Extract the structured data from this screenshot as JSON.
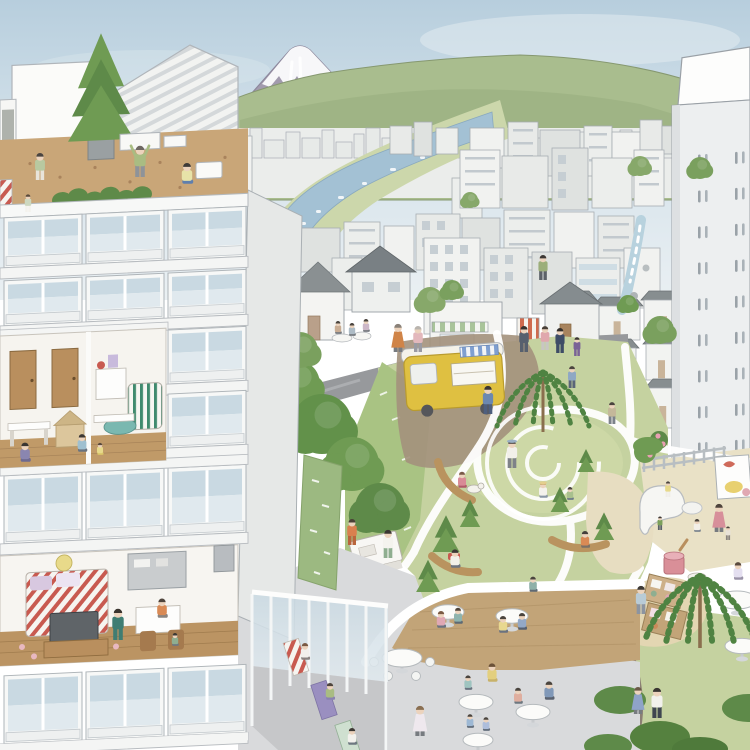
{
  "scene": {
    "description": "Watercolor illustration of a Japanese city: apartment tower cross-section with rooftop garden on the left, Mount Fuji and hills behind a dense low-rise city with a river, a waterfall stream, a park with winding white paths, spiral lawn, playground, yellow food-truck, market stalls, cafe plaza and a glass yoga studio."
  },
  "palette": {
    "sky_top": "#b7cedd",
    "sky": "#d3e1ea",
    "sky_low": "#e9eff3",
    "fuji": "#a29bae",
    "fuji_snow": "#f7f7f9",
    "hill": "#a9bd8e",
    "hill_dark": "#97ad7d",
    "field": "#ccd7ab",
    "river": "#a3c1d4",
    "city_base": "#ebedeb",
    "roof_dark": "#878e90",
    "road": "#97999c",
    "dirt": "#a3917c",
    "lawn": "#c5d2a0",
    "lawn_light": "#cdd8a6",
    "lawn_bright": "#a9c383",
    "path_white": "#ffffff",
    "soil": "#c9a678",
    "deck": "#c2a478",
    "plaza": "#d9dadc",
    "sand": "#e7ddc1",
    "truck_yellow": "#dfc041",
    "truck_trim": "#b99b2e",
    "awning_blue": "#7f9fd0",
    "moss": "#9cb981",
    "tree": "#6f9b53",
    "tree_dark": "#5e8a49",
    "willow": "#4f8342",
    "glass_top": "#c9d9e2",
    "glass_bottom": "#e0e9ee",
    "wood": "#b98f5e",
    "wall": "#f6f6f4",
    "wall_side": "#e6e8e7",
    "skin": "#ecd3bd",
    "stream": "#b8d2de",
    "bench_wood": "#b9935f",
    "cup_pink": "#d98f98",
    "flower_pink": "#e8a0b2"
  },
  "skyline": [
    [
      232,
      16,
      22
    ],
    [
      250,
      12,
      30
    ],
    [
      264,
      20,
      18
    ],
    [
      286,
      14,
      26
    ],
    [
      302,
      18,
      20
    ],
    [
      322,
      12,
      28
    ],
    [
      336,
      16,
      16
    ],
    [
      354,
      10,
      24
    ],
    [
      366,
      14,
      30
    ],
    [
      382,
      12,
      20
    ],
    [
      396,
      16,
      26
    ],
    [
      414,
      10,
      18
    ],
    [
      426,
      14,
      24
    ],
    [
      442,
      12,
      30
    ],
    [
      456,
      16,
      20
    ],
    [
      474,
      10,
      26
    ],
    [
      486,
      14,
      18
    ],
    [
      502,
      12,
      24
    ],
    [
      516,
      16,
      28
    ],
    [
      534,
      10,
      20
    ],
    [
      546,
      14,
      24
    ],
    [
      562,
      12,
      18
    ],
    [
      576,
      14,
      26
    ],
    [
      592,
      10,
      20
    ],
    [
      604,
      14,
      24
    ],
    [
      620,
      12,
      28
    ],
    [
      634,
      14,
      18
    ],
    [
      650,
      10,
      22
    ],
    [
      662,
      14,
      26
    ]
  ],
  "city": [
    [
      202,
      136,
      50,
      66,
      "d"
    ],
    [
      390,
      126,
      22,
      28,
      "p"
    ],
    [
      414,
      122,
      18,
      34,
      "p"
    ],
    [
      436,
      128,
      22,
      26,
      "p"
    ],
    [
      470,
      128,
      34,
      40,
      "p"
    ],
    [
      508,
      122,
      30,
      52,
      "d"
    ],
    [
      540,
      130,
      40,
      46,
      "p"
    ],
    [
      584,
      126,
      28,
      50,
      "d"
    ],
    [
      612,
      132,
      34,
      44,
      "p"
    ],
    [
      640,
      120,
      22,
      30,
      "p"
    ],
    [
      662,
      126,
      16,
      28,
      "p"
    ],
    [
      452,
      178,
      30,
      40,
      "p"
    ],
    [
      460,
      150,
      40,
      58,
      "d"
    ],
    [
      502,
      156,
      46,
      52,
      "p"
    ],
    [
      552,
      148,
      36,
      62,
      "g"
    ],
    [
      592,
      158,
      40,
      50,
      "p"
    ],
    [
      634,
      150,
      30,
      56,
      "d"
    ],
    [
      270,
      240,
      26,
      36,
      "p"
    ],
    [
      300,
      228,
      40,
      44,
      "p"
    ],
    [
      344,
      222,
      36,
      50,
      "d"
    ],
    [
      384,
      226,
      30,
      46,
      "p"
    ],
    [
      416,
      214,
      44,
      56,
      "g"
    ],
    [
      462,
      218,
      38,
      52,
      "p"
    ],
    [
      504,
      210,
      46,
      60,
      "d"
    ],
    [
      554,
      212,
      40,
      56,
      "p"
    ],
    [
      598,
      216,
      36,
      52,
      "d"
    ],
    [
      262,
      268,
      34,
      56,
      "p"
    ],
    [
      332,
      258,
      30,
      52,
      "p"
    ],
    [
      424,
      238,
      56,
      96,
      "g"
    ],
    [
      484,
      248,
      44,
      70,
      "g"
    ],
    [
      532,
      252,
      40,
      62,
      "p"
    ],
    [
      576,
      258,
      44,
      64,
      "b"
    ],
    [
      624,
      248,
      36,
      60,
      "p"
    ],
    [
      566,
      300,
      28,
      40,
      "r"
    ],
    [
      596,
      306,
      44,
      34,
      "r"
    ],
    [
      644,
      300,
      40,
      36,
      "r"
    ],
    [
      600,
      348,
      36,
      40,
      "r"
    ],
    [
      646,
      344,
      30,
      36,
      "r"
    ],
    [
      604,
      392,
      40,
      36,
      "r"
    ],
    [
      648,
      388,
      28,
      40,
      "r"
    ],
    [
      610,
      432,
      46,
      28,
      "r"
    ]
  ],
  "tower": {
    "row0": 46,
    "rows": 9,
    "step": 36,
    "cols": [
      20,
      57
    ]
  },
  "balconies": {
    "bays": [
      4,
      86,
      168
    ],
    "bay_w": 78,
    "width": 248,
    "rows": [
      {
        "y": 218,
        "h": 50,
        "bays": [
          0,
          1,
          2
        ]
      },
      {
        "y": 281,
        "h": 45,
        "bays": [
          0,
          1,
          2
        ]
      },
      {
        "y": 338,
        "h": 54,
        "bays": [
          2
        ]
      },
      {
        "y": 402,
        "h": 54,
        "bays": [
          2
        ]
      },
      {
        "y": 476,
        "h": 68,
        "bays": [
          0,
          1,
          2
        ]
      },
      {
        "y": 676,
        "h": 68,
        "bays": [
          0,
          1,
          2
        ]
      }
    ]
  },
  "trees": [
    {
      "t": "round",
      "x": 296,
      "y": 384,
      "r": 24,
      "c": "#6f9b53"
    },
    {
      "t": "round",
      "x": 322,
      "y": 424,
      "r": 30,
      "c": "#62914a"
    },
    {
      "t": "round",
      "x": 352,
      "y": 464,
      "r": 27,
      "c": "#6f9b53"
    },
    {
      "t": "round",
      "x": 380,
      "y": 508,
      "r": 25,
      "c": "#5e8a49"
    },
    {
      "t": "round",
      "x": 300,
      "y": 350,
      "r": 18,
      "c": "#7aa05e"
    },
    {
      "t": "round",
      "x": 268,
      "y": 356,
      "r": 15,
      "c": "#6f9b53"
    },
    {
      "t": "round",
      "x": 430,
      "y": 300,
      "r": 13,
      "c": "#87a86a"
    },
    {
      "t": "round",
      "x": 452,
      "y": 290,
      "r": 10,
      "c": "#7aa05e"
    },
    {
      "t": "round",
      "x": 660,
      "y": 330,
      "r": 14,
      "c": "#7aa05e"
    },
    {
      "t": "round",
      "x": 640,
      "y": 166,
      "r": 10,
      "c": "#87a86a"
    },
    {
      "t": "round",
      "x": 700,
      "y": 168,
      "r": 11,
      "c": "#7aa05e"
    },
    {
      "t": "round",
      "x": 470,
      "y": 200,
      "r": 8,
      "c": "#87a86a"
    },
    {
      "t": "round",
      "x": 628,
      "y": 304,
      "r": 9,
      "c": "#6f9b53"
    },
    {
      "t": "willow",
      "x": 543,
      "y": 432,
      "s": 1.0
    },
    {
      "t": "willow",
      "x": 700,
      "y": 648,
      "s": 1.2
    },
    {
      "t": "pine",
      "x": 446,
      "y": 552,
      "s": 0.8
    },
    {
      "t": "pine",
      "x": 470,
      "y": 527,
      "s": 0.6
    },
    {
      "t": "pine",
      "x": 428,
      "y": 592,
      "s": 0.7
    },
    {
      "t": "pine",
      "x": 560,
      "y": 512,
      "s": 0.55
    },
    {
      "t": "pine",
      "x": 604,
      "y": 540,
      "s": 0.6
    },
    {
      "t": "pine",
      "x": 586,
      "y": 472,
      "s": 0.5
    },
    {
      "t": "bush",
      "x": 620,
      "y": 700,
      "rx": 26,
      "ry": 14,
      "c": "#5e8a49"
    },
    {
      "t": "bush",
      "x": 660,
      "y": 737,
      "rx": 30,
      "ry": 16,
      "c": "#55813f"
    },
    {
      "t": "bush",
      "x": 608,
      "y": 746,
      "rx": 24,
      "ry": 12,
      "c": "#5e8a49"
    },
    {
      "t": "bush",
      "x": 748,
      "y": 708,
      "rx": 26,
      "ry": 14,
      "c": "#5e8a49"
    },
    {
      "t": "bush",
      "x": 700,
      "y": 749,
      "rx": 28,
      "ry": 12,
      "c": "#4f7a3b"
    },
    {
      "t": "bush",
      "x": 648,
      "y": 446,
      "rx": 15,
      "ry": 9,
      "c": "#6f9b53"
    }
  ],
  "tables": [
    {
      "x": 402,
      "y": 658,
      "r": 20,
      "empty": true
    },
    {
      "x": 448,
      "y": 612,
      "r": 16
    },
    {
      "x": 512,
      "y": 616,
      "r": 16
    },
    {
      "x": 476,
      "y": 702,
      "r": 17
    },
    {
      "x": 533,
      "y": 712,
      "r": 17
    },
    {
      "x": 478,
      "y": 740,
      "r": 15
    },
    {
      "x": 737,
      "y": 600,
      "r": 20
    },
    {
      "x": 742,
      "y": 646,
      "r": 17
    }
  ],
  "people": [
    {
      "x": 40,
      "y": 180,
      "h": 26,
      "shirt": "#b8c9a0",
      "pants": "#e8e4da",
      "hair": "#4a4440",
      "pose": "stand"
    },
    {
      "x": 28,
      "y": 212,
      "h": 17,
      "shirt": "#cdd8c0",
      "pants": "#f4f2ec",
      "hair": "#5a4a3c",
      "pose": "stand"
    },
    {
      "x": 140,
      "y": 177,
      "h": 30,
      "shirt": "#a9bc82",
      "pants": "#8e9399",
      "hair": "#6e6862",
      "pose": "stretch"
    },
    {
      "x": 187,
      "y": 184,
      "h": 26,
      "shirt": "#e7e3a8",
      "pants": "#5f7fae",
      "hair": "#3e3a38",
      "pose": "sit"
    },
    {
      "x": 398,
      "y": 352,
      "h": 27,
      "shirt": "#d08448",
      "hair": "#8a8178",
      "pose": "stand",
      "dress": true
    },
    {
      "x": 418,
      "y": 352,
      "h": 25,
      "shirt": "#e3b8bc",
      "pants": "#9a9aa2",
      "hair": "#b9b4ae",
      "pose": "stand"
    },
    {
      "x": 524,
      "y": 352,
      "h": 25,
      "shirt": "#57606e",
      "pants": "#57606e",
      "hair": "#36322e",
      "pose": "stand"
    },
    {
      "x": 545,
      "y": 350,
      "h": 23,
      "shirt": "#e0a8ad",
      "pants": "#c8c6c2",
      "hair": "#4a4038",
      "pose": "stand"
    },
    {
      "x": 560,
      "y": 353,
      "h": 24,
      "shirt": "#3e4c66",
      "pants": "#3e4c66",
      "hair": "#332f2c",
      "pose": "stand"
    },
    {
      "x": 577,
      "y": 356,
      "h": 18,
      "shirt": "#7a6296",
      "pants": "#7a6296",
      "hair": "#3a3632",
      "pose": "stand"
    },
    {
      "x": 543,
      "y": 280,
      "h": 24,
      "shirt": "#9cae7a",
      "pants": "#5c6168",
      "hair": "#3c3834",
      "pose": "stand"
    },
    {
      "x": 338,
      "y": 334,
      "h": 16,
      "shirt": "#c9ad94",
      "pose": "sit"
    },
    {
      "x": 352,
      "y": 336,
      "h": 16,
      "shirt": "#aebcc6",
      "pose": "sit"
    },
    {
      "x": 366,
      "y": 332,
      "h": 16,
      "shirt": "#cdb8c8",
      "pose": "sit"
    },
    {
      "x": 488,
      "y": 414,
      "h": 27,
      "shirt": "#6c88b0",
      "pants": "#4e5f7e",
      "hair": "#3c3630",
      "pose": "stand"
    },
    {
      "x": 512,
      "y": 468,
      "h": 27,
      "shirt": "#f2f0ea",
      "pants": "#7e8288",
      "hair": "#3e3a36",
      "pose": "stand",
      "hat": "#9ab0c4"
    },
    {
      "x": 462,
      "y": 488,
      "h": 20,
      "shirt": "#d98a96",
      "pants": "#b05a68",
      "hair": "#7a5a48",
      "pose": "sit"
    },
    {
      "x": 543,
      "y": 498,
      "h": 20,
      "shirt": "#f4f2ec",
      "pants": "#8a97a5",
      "hair": "#caa86a",
      "pose": "sit",
      "hat": "#e4cf8e"
    },
    {
      "x": 570,
      "y": 500,
      "h": 16,
      "shirt": "#a9c08e",
      "pants": "#6e7a88",
      "pose": "sit"
    },
    {
      "x": 612,
      "y": 424,
      "h": 21,
      "shirt": "#c4b89a",
      "pants": "#7c828a",
      "pose": "stand"
    },
    {
      "x": 572,
      "y": 388,
      "h": 21,
      "shirt": "#8fa8c4",
      "pants": "#5a6478",
      "pose": "stand"
    },
    {
      "x": 388,
      "y": 558,
      "h": 27,
      "shirt": "#f4f3ee",
      "pants": "#8fae90",
      "hair": "#3a3632",
      "pose": "stand"
    },
    {
      "x": 352,
      "y": 545,
      "h": 25,
      "shirt": "#d9804e",
      "pants": "#b9653c",
      "hair": "#4a4036",
      "pose": "stand"
    },
    {
      "x": 455,
      "y": 568,
      "h": 23,
      "shirt": "#f2f0ea",
      "pants": "#6e7480",
      "hair": "#3c3834",
      "pose": "sit"
    },
    {
      "x": 585,
      "y": 548,
      "h": 21,
      "shirt": "#d98a55",
      "pants": "#7a7066",
      "hair": "#44403c",
      "pose": "sit"
    },
    {
      "x": 533,
      "y": 592,
      "h": 19,
      "shirt": "#8fb0a8",
      "pants": "#5f6a74",
      "pose": "sit"
    },
    {
      "x": 660,
      "y": 530,
      "h": 13,
      "shirt": "#7ba05a",
      "pants": "#5a6268",
      "hair": "#3c3834",
      "pose": "stand"
    },
    {
      "x": 668,
      "y": 497,
      "h": 15,
      "shirt": "#e7d98a",
      "pants": "#f0eee8",
      "hair": "#4a4440",
      "pose": "stand"
    },
    {
      "x": 719,
      "y": 532,
      "h": 27,
      "shirt": "#d78f9a",
      "hair": "#4e443c",
      "pose": "stand",
      "dress": true
    },
    {
      "x": 728,
      "y": 540,
      "h": 13,
      "shirt": "#e8e2d8",
      "pants": "#8a8480",
      "pose": "stand"
    },
    {
      "x": 697,
      "y": 532,
      "h": 16,
      "shirt": "#f2efe8",
      "pants": "#7d8690",
      "pose": "sit"
    },
    {
      "x": 641,
      "y": 614,
      "h": 27,
      "shirt": "#b9cbd6",
      "pants": "#8c94a0",
      "hair": "#3e3a36",
      "pose": "stand"
    },
    {
      "x": 738,
      "y": 580,
      "h": 22,
      "shirt": "#e4dff0",
      "pants": "#9a93a8",
      "hair": "#5a4a3e",
      "pose": "sit"
    },
    {
      "x": 657,
      "y": 718,
      "h": 29,
      "shirt": "#f2f1ec",
      "pants": "#3f4650",
      "hair": "#3a3632",
      "pose": "stand"
    },
    {
      "x": 638,
      "y": 714,
      "h": 26,
      "shirt": "#8fa3c8",
      "hair": "#6b5a48",
      "pose": "stand",
      "dress": true
    },
    {
      "x": 441,
      "y": 628,
      "h": 21,
      "shirt": "#e0a8b4",
      "pants": "#6a7280",
      "hair": "#7a5a44",
      "pose": "sit"
    },
    {
      "x": 458,
      "y": 624,
      "h": 20,
      "shirt": "#8fb4ae",
      "pants": "#5e6a74",
      "hair": "#4e443c",
      "pose": "sit"
    },
    {
      "x": 503,
      "y": 633,
      "h": 21,
      "shirt": "#e8d88f",
      "pants": "#6a7280",
      "pose": "sit"
    },
    {
      "x": 522,
      "y": 630,
      "h": 21,
      "shirt": "#93a8c6",
      "pants": "#566070",
      "pose": "sit"
    },
    {
      "x": 468,
      "y": 690,
      "h": 18,
      "shirt": "#9fc4c0",
      "pants": "#6a7480",
      "pose": "sit"
    },
    {
      "x": 492,
      "y": 682,
      "h": 23,
      "shirt": "#e3cf7e",
      "pants": "#c8b26a",
      "hair": "#6b5138",
      "pose": "sit"
    },
    {
      "x": 518,
      "y": 704,
      "h": 20,
      "shirt": "#dfae9f",
      "pants": "#6e7880",
      "pose": "sit"
    },
    {
      "x": 549,
      "y": 700,
      "h": 23,
      "shirt": "#8098b8",
      "pants": "#5a6270",
      "pose": "sit"
    },
    {
      "x": 470,
      "y": 728,
      "h": 17,
      "shirt": "#9db8d4",
      "pants": "#65707e",
      "pose": "sit"
    },
    {
      "x": 486,
      "y": 731,
      "h": 17,
      "shirt": "#aebedb",
      "pants": "#65707e",
      "pose": "sit"
    },
    {
      "x": 420,
      "y": 736,
      "h": 29,
      "shirt": "#efe8ee",
      "hair": "#8a6f52",
      "pose": "stand",
      "dress": true
    },
    {
      "x": 305,
      "y": 660,
      "h": 21,
      "shirt": "#f2f1ec",
      "pants": "#8a8480",
      "hair": "#7a5a44",
      "pose": "sit"
    },
    {
      "x": 330,
      "y": 700,
      "h": 21,
      "shirt": "#a9bc82",
      "pants": "#8a82b0",
      "hair": "#4e443c",
      "pose": "sit"
    },
    {
      "x": 352,
      "y": 745,
      "h": 21,
      "shirt": "#f2f1ec",
      "pants": "#6e7880",
      "hair": "#3c3834",
      "pose": "sit"
    },
    {
      "x": 25,
      "y": 462,
      "h": 24,
      "shirt": "#8a86b0",
      "pants": "#6e6a90",
      "hair": "#3a3632",
      "pose": "sit"
    },
    {
      "x": 82,
      "y": 452,
      "h": 22,
      "shirt": "#9fc0d0",
      "pants": "#6a7480",
      "hair": "#3c3834",
      "pose": "sit"
    },
    {
      "x": 100,
      "y": 455,
      "h": 15,
      "shirt": "#e7d98a",
      "pants": "#d9c468",
      "hair": "#5a4a3c",
      "pose": "sit"
    },
    {
      "x": 118,
      "y": 640,
      "h": 30,
      "shirt": "#3f7d72",
      "pants": "#3f7d72",
      "hair": "#3a342e",
      "pose": "stand"
    },
    {
      "x": 162,
      "y": 618,
      "h": 24,
      "shirt": "#d98a55",
      "pants": "#8a8480",
      "hair": "#4e443c",
      "pose": "sit"
    },
    {
      "x": 175,
      "y": 646,
      "h": 16,
      "shirt": "#8fae90",
      "pants": "#6e7880",
      "hair": "#3c3834",
      "pose": "sit"
    }
  ]
}
